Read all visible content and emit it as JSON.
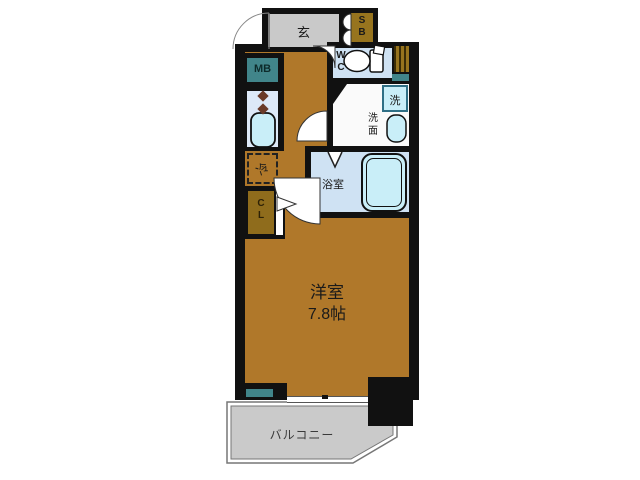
{
  "plan": {
    "entrance_label": "玄",
    "shoe_box": [
      "S",
      "B"
    ],
    "wc": [
      "W",
      "C"
    ],
    "meter_box_label": "MB",
    "washer_label": "洗",
    "washroom": [
      "洗",
      "面"
    ],
    "bathroom_label": "浴室",
    "closet": [
      "C",
      "L"
    ],
    "fridge_label": "冷",
    "room_label": "洋室",
    "room_size": "7.8帖",
    "balcony_label": "バルコニー"
  },
  "colors": {
    "wall": "#111111",
    "room_floor": "#b0782a",
    "wood_box": "#97741e",
    "teal": "#41858a",
    "entrance_gray": "#c9c9c9",
    "balcony_gray": "#cacaca",
    "wet_floor_blue": "#cfe2f3",
    "kitchen_strip": "#dde9f8",
    "fixture_blue": "#c9eef8",
    "washroom_white": "#fafafa"
  }
}
